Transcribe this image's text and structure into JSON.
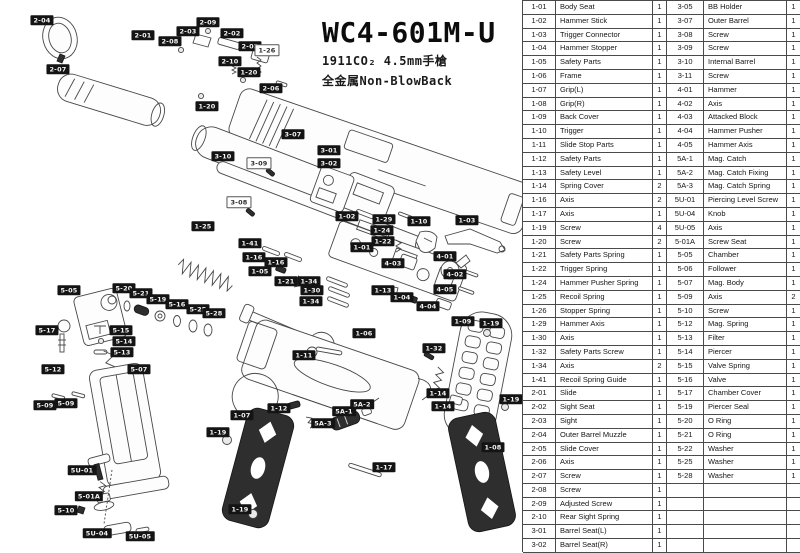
{
  "title": {
    "model": "WC4-601M-U",
    "subtitle1": "1911CO₂ 4.5mm手槍",
    "subtitle2": "全金属Non-BlowBack"
  },
  "parts_table": {
    "left_rows": [
      [
        "1-01",
        "Body Seat",
        "1"
      ],
      [
        "1-02",
        "Hammer Stick",
        "1"
      ],
      [
        "1-03",
        "Trigger Connector",
        "1"
      ],
      [
        "1-04",
        "Hammer Stopper",
        "1"
      ],
      [
        "1-05",
        "Safety Parts",
        "1"
      ],
      [
        "1-06",
        "Frame",
        "1"
      ],
      [
        "1-07",
        "Grip(L)",
        "1"
      ],
      [
        "1-08",
        "Grip(R)",
        "1"
      ],
      [
        "1-09",
        "Back Cover",
        "1"
      ],
      [
        "1-10",
        "Trigger",
        "1"
      ],
      [
        "1-11",
        "Slide Stop Parts",
        "1"
      ],
      [
        "1-12",
        "Safety Parts",
        "1"
      ],
      [
        "1-13",
        "Safety Level",
        "1"
      ],
      [
        "1-14",
        "Spring Cover",
        "2"
      ],
      [
        "1-16",
        "Axis",
        "2"
      ],
      [
        "1-17",
        "Axis",
        "1"
      ],
      [
        "1-19",
        "Screw",
        "4"
      ],
      [
        "1-20",
        "Screw",
        "2"
      ],
      [
        "1-21",
        "Safety Parts Spring",
        "1"
      ],
      [
        "1-22",
        "Trigger Spring",
        "1"
      ],
      [
        "1-24",
        "Hammer Pusher Spring",
        "1"
      ],
      [
        "1-25",
        "Recoil  Spring",
        "1"
      ],
      [
        "1-26",
        "Stopper Spring",
        "1"
      ],
      [
        "1-29",
        "Hammer Axis",
        "1"
      ],
      [
        "1-30",
        "Axis",
        "1"
      ],
      [
        "1-32",
        "Safety Parts Screw",
        "1"
      ],
      [
        "1-34",
        "Axis",
        "2"
      ],
      [
        "1-41",
        "Recoil Spring Guide",
        "1"
      ],
      [
        "2-01",
        "Slide",
        "1"
      ],
      [
        "2-02",
        "Sight Seat",
        "1"
      ],
      [
        "2-03",
        "Sight",
        "1"
      ],
      [
        "2-04",
        "Outer Barrel Muzzle",
        "1"
      ],
      [
        "2-05",
        "Slide Cover",
        "1"
      ],
      [
        "2-06",
        "Axis",
        "1"
      ],
      [
        "2-07",
        "Screw",
        "1"
      ],
      [
        "2-08",
        "Screw",
        "1"
      ],
      [
        "2-09",
        "Adjusted Screw",
        "1"
      ],
      [
        "2-10",
        "Rear Sight Spring",
        "1"
      ],
      [
        "3-01",
        "Barrel Seat(L)",
        "1"
      ],
      [
        "3-02",
        "Barrel Seat(R)",
        "1"
      ]
    ],
    "right_rows": [
      [
        "3-05",
        "BB Holder",
        "1"
      ],
      [
        "3-07",
        "Outer Barrel",
        "1"
      ],
      [
        "3-08",
        "Screw",
        "1"
      ],
      [
        "3-09",
        "Screw",
        "1"
      ],
      [
        "3-10",
        "Internal Barrel",
        "1"
      ],
      [
        "3-11",
        "Screw",
        "1"
      ],
      [
        "4-01",
        "Hammer",
        "1"
      ],
      [
        "4-02",
        "Axis",
        "1"
      ],
      [
        "4-03",
        "Attacked Block",
        "1"
      ],
      [
        "4-04",
        "Hammer Pusher",
        "1"
      ],
      [
        "4-05",
        "Hammer Axis",
        "1"
      ],
      [
        "5A-1",
        "Mag. Catch",
        "1"
      ],
      [
        "5A-2",
        "Mag. Catch Fixing",
        "1"
      ],
      [
        "5A-3",
        "Mag. Catch Spring",
        "1"
      ],
      [
        "5U-01",
        "Piercing Level Screw",
        "1"
      ],
      [
        "5U-04",
        "Knob",
        "1"
      ],
      [
        "5U-05",
        "Axis",
        "1"
      ],
      [
        "5-01A",
        "Screw Seat",
        "1"
      ],
      [
        "5-05",
        "Chamber",
        "1"
      ],
      [
        "5-06",
        "Follower",
        "1"
      ],
      [
        "5-07",
        "Mag. Body",
        "1"
      ],
      [
        "5-09",
        "Axis",
        "2"
      ],
      [
        "5-10",
        "Screw",
        "1"
      ],
      [
        "5-12",
        "Mag. Spring",
        "1"
      ],
      [
        "5-13",
        "Filter",
        "1"
      ],
      [
        "5-14",
        "Piercer",
        "1"
      ],
      [
        "5-15",
        "Valve Spring",
        "1"
      ],
      [
        "5-16",
        "Valve",
        "1"
      ],
      [
        "5-17",
        "Chamber Cover",
        "1"
      ],
      [
        "5-19",
        "Piercer Seal",
        "1"
      ],
      [
        "5-20",
        "O Ring",
        "1"
      ],
      [
        "5-21",
        "O Ring",
        "1"
      ],
      [
        "5-22",
        "Washer",
        "1"
      ],
      [
        "5-25",
        "Washer",
        "1"
      ],
      [
        "5-28",
        "Washer",
        "1"
      ],
      [
        "",
        "",
        ""
      ],
      [
        "",
        "",
        ""
      ],
      [
        "",
        "",
        ""
      ],
      [
        "",
        "",
        ""
      ],
      [
        "",
        "",
        ""
      ]
    ]
  },
  "diagram": {
    "labels": [
      {
        "t": "2-04",
        "x": 42,
        "y": 20
      },
      {
        "t": "2-07",
        "x": 58,
        "y": 69
      },
      {
        "t": "2-01",
        "x": 143,
        "y": 35
      },
      {
        "t": "2-08",
        "x": 170,
        "y": 41
      },
      {
        "t": "2-09",
        "x": 208,
        "y": 22
      },
      {
        "t": "2-03",
        "x": 188,
        "y": 31
      },
      {
        "t": "2-02",
        "x": 232,
        "y": 33
      },
      {
        "t": "2-05",
        "x": 250,
        "y": 46
      },
      {
        "t": "1-26",
        "x": 267,
        "y": 50,
        "s": "o"
      },
      {
        "t": "2-10",
        "x": 230,
        "y": 61
      },
      {
        "t": "1-20",
        "x": 249,
        "y": 72
      },
      {
        "t": "2-06",
        "x": 271,
        "y": 88
      },
      {
        "t": "1-20",
        "x": 207,
        "y": 106
      },
      {
        "t": "3-07",
        "x": 293,
        "y": 134
      },
      {
        "t": "3-10",
        "x": 223,
        "y": 156
      },
      {
        "t": "3-09",
        "x": 259,
        "y": 163,
        "s": "o"
      },
      {
        "t": "3-01",
        "x": 329,
        "y": 150
      },
      {
        "t": "3-02",
        "x": 329,
        "y": 163
      },
      {
        "t": "3-08",
        "x": 239,
        "y": 202,
        "s": "o"
      },
      {
        "t": "1-25",
        "x": 203,
        "y": 226
      },
      {
        "t": "1-02",
        "x": 347,
        "y": 216
      },
      {
        "t": "1-29",
        "x": 384,
        "y": 219
      },
      {
        "t": "1-24",
        "x": 382,
        "y": 230
      },
      {
        "t": "1-22",
        "x": 383,
        "y": 241
      },
      {
        "t": "1-10",
        "x": 419,
        "y": 221
      },
      {
        "t": "1-03",
        "x": 467,
        "y": 220
      },
      {
        "t": "1-01",
        "x": 362,
        "y": 247
      },
      {
        "t": "4-03",
        "x": 393,
        "y": 263
      },
      {
        "t": "4-01",
        "x": 445,
        "y": 256
      },
      {
        "t": "4-02",
        "x": 455,
        "y": 274
      },
      {
        "t": "4-05",
        "x": 445,
        "y": 289
      },
      {
        "t": "4-04",
        "x": 428,
        "y": 306
      },
      {
        "t": "1-04",
        "x": 402,
        "y": 297
      },
      {
        "t": "1-13",
        "x": 383,
        "y": 290
      },
      {
        "t": "1-41",
        "x": 250,
        "y": 243
      },
      {
        "t": "1-16",
        "x": 254,
        "y": 257
      },
      {
        "t": "1-16",
        "x": 276,
        "y": 262
      },
      {
        "t": "1-05",
        "x": 260,
        "y": 271
      },
      {
        "t": "1-21",
        "x": 286,
        "y": 281
      },
      {
        "t": "1-34",
        "x": 309,
        "y": 281
      },
      {
        "t": "1-30",
        "x": 312,
        "y": 290
      },
      {
        "t": "1-34",
        "x": 311,
        "y": 301
      },
      {
        "t": "1-11",
        "x": 304,
        "y": 355
      },
      {
        "t": "1-06",
        "x": 364,
        "y": 333
      },
      {
        "t": "1-09",
        "x": 463,
        "y": 321
      },
      {
        "t": "1-19",
        "x": 491,
        "y": 323
      },
      {
        "t": "1-32",
        "x": 434,
        "y": 348
      },
      {
        "t": "1-14",
        "x": 438,
        "y": 393
      },
      {
        "t": "1-14",
        "x": 443,
        "y": 406
      },
      {
        "t": "1-19",
        "x": 511,
        "y": 399
      },
      {
        "t": "1-08",
        "x": 493,
        "y": 447
      },
      {
        "t": "1-07",
        "x": 242,
        "y": 415
      },
      {
        "t": "1-19",
        "x": 218,
        "y": 432
      },
      {
        "t": "1-19",
        "x": 240,
        "y": 509
      },
      {
        "t": "1-12",
        "x": 279,
        "y": 408
      },
      {
        "t": "5A-3",
        "x": 323,
        "y": 423
      },
      {
        "t": "5A-1",
        "x": 344,
        "y": 411
      },
      {
        "t": "5A-2",
        "x": 362,
        "y": 404
      },
      {
        "t": "1-17",
        "x": 384,
        "y": 467
      },
      {
        "t": "5-05",
        "x": 69,
        "y": 290
      },
      {
        "t": "5-20",
        "x": 124,
        "y": 288
      },
      {
        "t": "5-21",
        "x": 141,
        "y": 293
      },
      {
        "t": "5-19",
        "x": 158,
        "y": 299
      },
      {
        "t": "5-16",
        "x": 177,
        "y": 304
      },
      {
        "t": "5-25",
        "x": 198,
        "y": 309
      },
      {
        "t": "5-28",
        "x": 214,
        "y": 313
      },
      {
        "t": "5-17",
        "x": 47,
        "y": 330
      },
      {
        "t": "5-15",
        "x": 121,
        "y": 330
      },
      {
        "t": "5-14",
        "x": 124,
        "y": 341
      },
      {
        "t": "5-13",
        "x": 122,
        "y": 352
      },
      {
        "t": "5-12",
        "x": 53,
        "y": 369
      },
      {
        "t": "5-07",
        "x": 139,
        "y": 369
      },
      {
        "t": "5-09",
        "x": 45,
        "y": 405
      },
      {
        "t": "5-09",
        "x": 66,
        "y": 403
      },
      {
        "t": "5U-01",
        "x": 82,
        "y": 470
      },
      {
        "t": "5-01A",
        "x": 89,
        "y": 496
      },
      {
        "t": "5-10",
        "x": 66,
        "y": 510
      },
      {
        "t": "5U-04",
        "x": 97,
        "y": 533
      },
      {
        "t": "5U-05",
        "x": 140,
        "y": 536
      }
    ]
  },
  "colors": {
    "label_bg": "#141414",
    "label_text": "#f4f4f4",
    "line": "#474747",
    "table_border": "#4a4a4a",
    "grip_fill": "#2e2e2e"
  }
}
